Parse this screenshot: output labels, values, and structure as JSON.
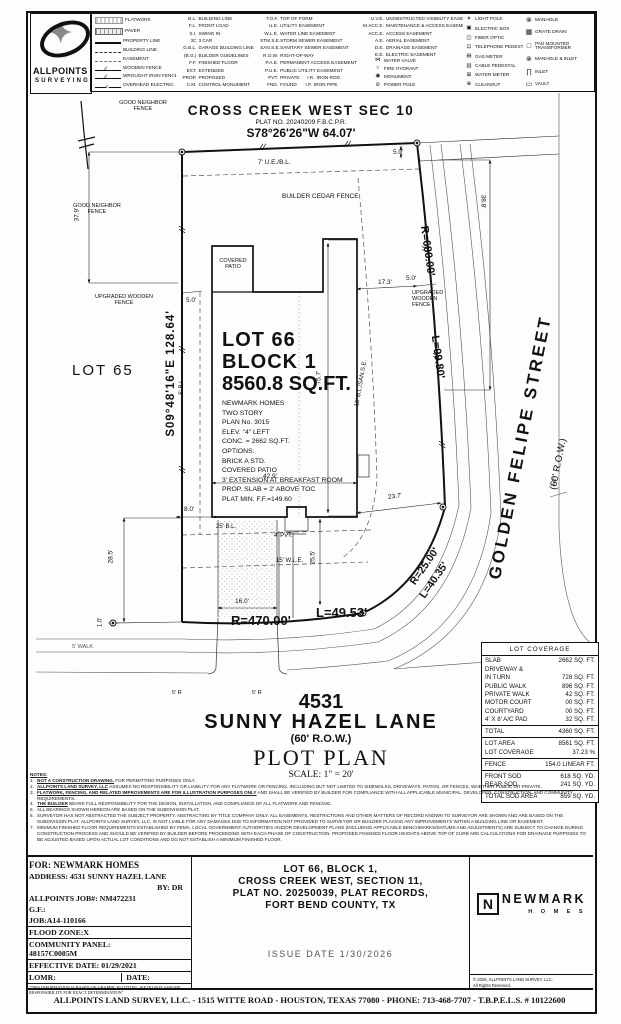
{
  "legend": {
    "logo": {
      "line1": "ALLPOINTS",
      "line2": "SURVEYING"
    },
    "line_items": [
      {
        "icon": "flatwork-swatch",
        "label": "FLATWORK"
      },
      {
        "icon": "paver-swatch",
        "label": "PAVER"
      },
      {
        "icon": "property-line",
        "label": "PROPERTY LINE"
      },
      {
        "icon": "building-line",
        "label": "BUILDING LINE"
      },
      {
        "icon": "easement-line",
        "label": "EASEMENT"
      },
      {
        "icon": "wooden-fence-line",
        "label": "WOODEN FENCE"
      },
      {
        "icon": "wrought-iron-fence-line",
        "label": "WROUGHT IRON FENCE"
      },
      {
        "icon": "overhead-electric-line",
        "label": "OVERHEAD ELECTRIC"
      }
    ],
    "abbrev_col1": [
      {
        "abbr": "B.L.",
        "term": "BUILDING LINE"
      },
      {
        "abbr": "F.L.",
        "term": "FRONT LOAD"
      },
      {
        "abbr": "S.I.",
        "term": "SWING IN"
      },
      {
        "abbr": "3C",
        "term": "3 CAR"
      },
      {
        "abbr": "G.B.L.",
        "term": "GARAGE BUILDING LINE"
      },
      {
        "abbr": "(B.G.)",
        "term": "BUILDER GUIDELINES"
      },
      {
        "abbr": "F.F.",
        "term": "FINISHED FLOOR"
      },
      {
        "abbr": "EXT.",
        "term": "EXTENDED"
      },
      {
        "abbr": "PROP.",
        "term": "PROPOSED"
      },
      {
        "abbr": "C.M.",
        "term": "CONTROL MONUMENT"
      }
    ],
    "abbrev_col2": [
      {
        "abbr": "T.O.F.",
        "term": "TOP OF FORM"
      },
      {
        "abbr": "U.E.",
        "term": "UTILITY EASEMENT"
      },
      {
        "abbr": "W.L.E.",
        "term": "WATER LINE EASEMENT"
      },
      {
        "abbr": "STM.S.E.",
        "term": "STORM SEWER EASEMENT"
      },
      {
        "abbr": "SAN.S.E.",
        "term": "SANITARY SEWER EASEMENT"
      },
      {
        "abbr": "R.O.W.",
        "term": "RIGHT-OF-WAY"
      },
      {
        "abbr": "P.A.E.",
        "term": "PERMANENT ACCESS EASEMENT"
      },
      {
        "abbr": "P.U.E.",
        "term": "PUBLIC UTILITY EASEMENT"
      },
      {
        "abbr": "PVT.",
        "term": "PRIVATE",
        "abbr2": "I.R.",
        "term2": "IRON ROD"
      },
      {
        "abbr": "FND.",
        "term": "FOUND",
        "abbr2": "I.P.",
        "term2": "IRON PIPE"
      }
    ],
    "abbrev_col3": [
      {
        "abbr": "U.V.E.",
        "term": "UNOBSTRUCTED VISIBILITY EASEMENT"
      },
      {
        "abbr": "M.ACC.E.",
        "term": "MAINTENANCE & ACCESS EASEMENT"
      },
      {
        "abbr": "ACC.E.",
        "term": "ACCESS EASEMENT"
      },
      {
        "abbr": "A.E.",
        "term": "AERIAL EASEMENT"
      },
      {
        "abbr": "D.E.",
        "term": "DRAINAGE EASEMENT"
      },
      {
        "abbr": "E.E.",
        "term": "ELECTRIC EASEMENT"
      }
    ],
    "symbol_col3": [
      {
        "icon": "water-valve-icon",
        "label": "WATER VALVE"
      },
      {
        "icon": "fire-hydrant-icon",
        "label": "FIRE HYDRANT"
      },
      {
        "icon": "monument-icon",
        "label": "MONUMENT"
      },
      {
        "icon": "power-pole-icon",
        "label": "POWER POLE"
      }
    ],
    "symbol_col4": [
      {
        "icon": "light-pole-icon",
        "label": "LIGHT POLE"
      },
      {
        "icon": "electric-box-icon",
        "label": "ELECTRIC BOX"
      },
      {
        "icon": "fiber-optic-icon",
        "label": "FIBER OPTIC"
      },
      {
        "icon": "telephone-pedestal-icon",
        "label": "TELEPHONE PEDESTAL"
      },
      {
        "icon": "gas-meter-icon",
        "label": "GAS METER"
      },
      {
        "icon": "cable-pedestal-icon",
        "label": "CABLE PEDESTAL"
      },
      {
        "icon": "water-meter-icon",
        "label": "WATER METER"
      },
      {
        "icon": "cleanout-icon",
        "label": "CLEANOUT"
      }
    ],
    "symbol_col5": [
      {
        "icon": "manhole-icon",
        "label": "MANHOLE"
      },
      {
        "icon": "grate-drain-icon",
        "label": "GRATE DRAIN"
      },
      {
        "icon": "pad-mounted-transformer-icon",
        "label": "PAD MOUNTED TRANSFORMER"
      },
      {
        "icon": "manhole-inlet-icon",
        "label": "MANHOLE & INLET"
      },
      {
        "icon": "inlet-icon",
        "label": "INLET"
      },
      {
        "icon": "vault-icon",
        "label": "VAULT"
      }
    ]
  },
  "drawing": {
    "labels": {
      "subdivision": "CROSS CREEK WEST SEC 10",
      "plat_no": "PLAT NO. 20240209 F.B.C.P.R.",
      "bearing_top": "S78°26'26\"W   64.07'",
      "bearing_left": "S09°48'16\"E   128.64'",
      "good_neighbor": "GOOD NEIGHBOR",
      "fence": "FENCE",
      "upgraded_wooden": "UPGRADED WOODEN",
      "upgraded": "UPGRADED",
      "wooden": "WOODEN",
      "builder_cedar": "BUILDER CEDAR FENCE",
      "ue7": "7' U.E./B.L.",
      "d50": "5.0'",
      "d388": "38.8'",
      "r680": "R=680.00'",
      "l9980": "L=99.80'",
      "golden": "GOLDEN FELIPE STREET",
      "row60": "(60' R.O.W.)",
      "covered": "COVERED",
      "patio": "PATIO",
      "lot66": "LOT 66",
      "block1": "BLOCK 1",
      "area": "8560.8 SQ.FT.",
      "lot65": "LOT 65",
      "d379": "37.9'",
      "bl5": "5' B.L.",
      "bl15": "15' B.L./SAN.S.E.",
      "d757": "75.7'",
      "d429": "42.9'",
      "d80": "8.0'",
      "bl25": "25' B.L.",
      "pvt4": "4' PVT.",
      "wle15": "15' W.L.E.",
      "d255": "25.5'",
      "d237": "23.7'",
      "d285": "28.5'",
      "d10": "1.0'",
      "d160": "16.0'",
      "d173": "17.3'",
      "r470": "R=470.00'",
      "l4953": "L=49.53'",
      "r25": "R=25.00'",
      "l4035": "L=40.35'",
      "walk5": "5' WALK",
      "r5": "5' R"
    },
    "specs": [
      "NEWMARK HOMES",
      "TWO STORY",
      "PLAN No. 3015",
      "ELEV. \"4\" LEFT",
      "CONC. = 2662 SQ.FT.",
      "OPTIONS:",
      "BRICK A STD.",
      "COVERED PATIO",
      "3' EXTENSION AT BREAKFAST ROOM",
      "PROP. SLAB = 2' ABOVE TOC",
      "PLAT MIN. F.F.=149.60"
    ]
  },
  "titles": {
    "number": "4531",
    "street": "SUNNY HAZEL LANE",
    "row": "(60' R.O.W.)",
    "plot_plan": "PLOT PLAN",
    "scale": "SCALE: 1\" = 20'"
  },
  "lot_coverage": {
    "title": "LOT COVERAGE",
    "rows": [
      {
        "label": "SLAB",
        "value": "2662 SQ. FT."
      },
      {
        "label": "DRIVEWAY &",
        "value": ""
      },
      {
        "label": "IN TURN",
        "value": "728 SQ. FT."
      },
      {
        "label": "PUBLIC WALK",
        "value": "896 SQ. FT."
      },
      {
        "label": "PRIVATE WALK",
        "value": "42 SQ. FT."
      },
      {
        "label": "MOTOR COURT",
        "value": "00 SQ. FT."
      },
      {
        "label": "COURTYARD",
        "value": "00 SQ. FT."
      },
      {
        "label": "4' X 8' A/C PAD",
        "value": "32 SQ. FT."
      },
      {
        "label": "TOTAL",
        "value": "4360 SQ. FT."
      },
      {
        "label": "LOT AREA",
        "value": "8561 SQ. FT."
      },
      {
        "label": "LOT COVERAGE",
        "value": "37.23 %"
      },
      {
        "label": "FENCE",
        "value": "154.0 LINEAR FT."
      },
      {
        "label": "FRONT SOD",
        "value": "618 SQ. YD."
      },
      {
        "label": "REAR SOD",
        "value": "241 SQ. YD."
      },
      {
        "label": "TOTAL SOD AREA",
        "value": "859 SQ. YD."
      }
    ]
  },
  "notes": {
    "heading": "NOTES:",
    "items": [
      {
        "num": "1.",
        "lead": "NOT A CONSTRUCTION DRAWING.",
        "rest": " FOR PERMITTING PURPOSES ONLY."
      },
      {
        "num": "2.",
        "lead": "ALLPOINTS LAND SURVEY, LLC",
        "rest": " ASSUMES NO RESPONSIBILITY OR LIABILITY FOR ANY FLATWORK OR FENCING, INCLUDING BUT NOT LIMITED TO SIDEWALKS, DRIVEWAYS, PATIOS, OR FENCES, WHETHER PUBLIC OR PRIVATE."
      },
      {
        "num": "3.",
        "lead": "FLATWORK, FENCING, AND RELATED IMPROVEMENTS ARE FOR ILLUSTRATION PURPOSES ONLY",
        "rest": " AND SHALL BE VERIFIED BY BUILDER FOR COMPLIANCE WITH ALL APPLICABLE MUNICIPAL, DEVELOPER, CONSTRUCTION, AND COMMUNITY REQUIREMENTS."
      },
      {
        "num": "4.",
        "lead": "THE BUILDER",
        "rest": " BEARS FULL RESPONSIBILITY FOR THE DESIGN, INSTALLATION, AND COMPLIANCE OF ALL FLATWORK AND FENCING."
      },
      {
        "num": "5.",
        "lead": "",
        "rest": "ALL BEARINGS SHOWN HEREON ARE BASED ON THE SUBDIVISION PLAT."
      },
      {
        "num": "6.",
        "lead": "",
        "rest": "SURVEYOR HAS NOT ABSTRACTED THE SUBJECT PROPERTY. ABSTRACTING BY TITLE COMPANY ONLY. ALL EASEMENTS, RESTRICTIONS AND OTHER MATTERS OF RECORD KNOWN TO SURVEYOR ARE SHOWN AND ARE BASED ON THE SUBDIVISION PLAT. ALLPOINTS LAND SURVEY, LLC. IS NOT LIABLE FOR ANY DAMAGES DUE TO INFORMATION NOT PROVIDED TO SURVEYOR OR BUILDER PLACING ANY IMPROVEMENTS WITHIN A BUILDING LINE OR EASEMENT."
      },
      {
        "num": "7.",
        "lead": "",
        "rest": "MINIMUM FINISHED FLOOR REQUIREMENTS ESTABLISHED BY FEMA, LOCAL GOVERNMENT AUTHORITIES AND/OR DEVELOPMENT PLANS (INCLUDING APPLICABLE BENCHMARKS/DATUMS AND ADJUSTMENTS) ARE SUBJECT TO CHANGE DURING CONSTRUCTION PROCESS AND SHOULD BE VERIFIED BY BUILDER BEFORE PROCEEDING WITH EACH PHASE OF CONSTRUCTION. PROPOSED FINISHED FLOOR HEIGHTS ABOVE TOP OF CURB ARE CALCULATIONS FOR DRAINAGE PURPOSES TO BE ADJUSTED BASED UPON ACTUAL LOT CONDITIONS AND DO NOT ESTABLISH A MINIMUM FINISHED FLOOR."
      }
    ]
  },
  "info": {
    "for": "FOR:  NEWMARK HOMES",
    "address": "ADDRESS: 4531 SUNNY HAZEL LANE",
    "by": "BY: DR",
    "job": "ALLPOINTS JOB#: NM472231",
    "gf": "G.F.:",
    "job2": "JOB:A14-110166",
    "flood": "FLOOD ZONE:X",
    "panel_label": "COMMUNITY PANEL:",
    "panel_value": "48157C0085M",
    "effective": "EFFECTIVE DATE: 01/29/2021",
    "lomr": "LOMR:",
    "date": "DATE:",
    "disclaimer": "\"THIS INFORMATION IS BASED ON GRAPHIC PLOTTING.  WE DO NOT ASSUME RESPONSIBILITY FOR EXACT DETERMINATION\""
  },
  "legal": {
    "lines": [
      "LOT 66, BLOCK 1,",
      "CROSS CREEK WEST, SECTION 11,",
      "PLAT NO. 20250039, PLAT RECORDS,",
      "FORT BEND COUNTY, TX"
    ],
    "issue_date": "ISSUE DATE 1/30/2026"
  },
  "branding": {
    "logo_n": "N",
    "name": "NEWMARK",
    "homes": "H O M E S",
    "copyright1": "© 2026, ALLPOINTS LAND SURVEY, LLC.",
    "copyright2": "All Rights Reserved."
  },
  "footer": {
    "text": "ALLPOINTS LAND SURVEY, LLC. - 1515 WITTE ROAD - HOUSTON, TEXAS 77080 - PHONE: 713-468-7707 - T.B.P.E.L.S. # 10122600"
  }
}
